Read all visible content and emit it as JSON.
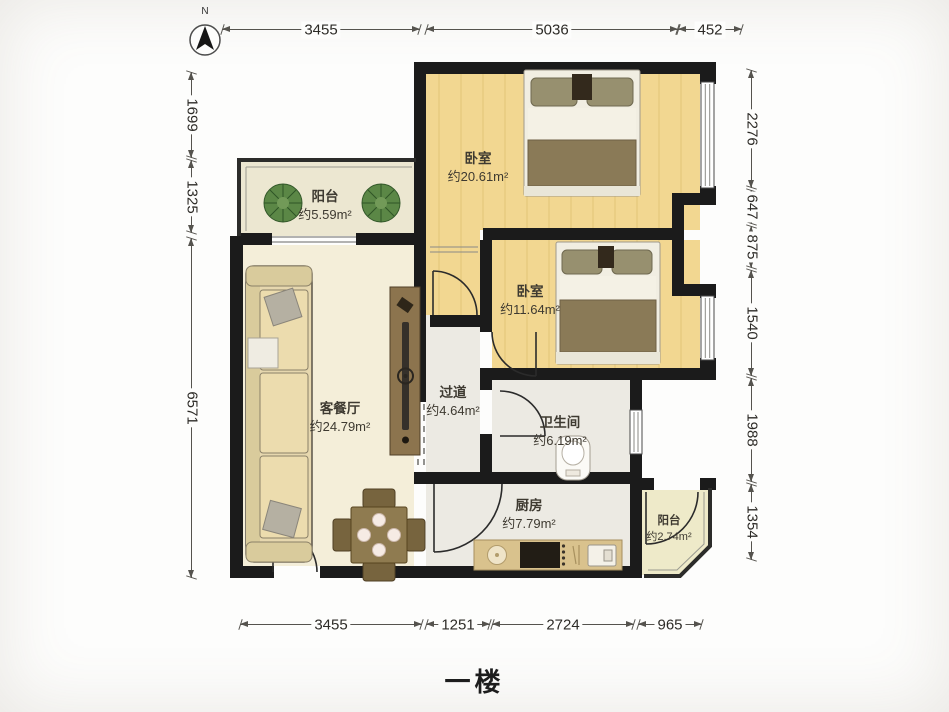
{
  "title": "一楼",
  "compass": {
    "label": "N"
  },
  "rooms": [
    {
      "id": "balcony-top",
      "name": "阳台",
      "area": "约5.59m²"
    },
    {
      "id": "bedroom-1",
      "name": "卧室",
      "area": "约20.61m²"
    },
    {
      "id": "bedroom-2",
      "name": "卧室",
      "area": "约11.64m²"
    },
    {
      "id": "living-dining",
      "name": "客餐厅",
      "area": "约24.79m²"
    },
    {
      "id": "hallway",
      "name": "过道",
      "area": "约4.64m²"
    },
    {
      "id": "bathroom",
      "name": "卫生间",
      "area": "约6.19m²"
    },
    {
      "id": "kitchen",
      "name": "厨房",
      "area": "约7.79m²"
    },
    {
      "id": "balcony-bottom",
      "name": "阳台",
      "area": "约2.74m²"
    }
  ],
  "dimensions": {
    "top": [
      "3455",
      "5036",
      "452"
    ],
    "bottom": [
      "3455",
      "1251",
      "2724",
      "965"
    ],
    "left": [
      "1699",
      "1325",
      "6571"
    ],
    "right": [
      "2276",
      "647",
      "875",
      "1540",
      "1988",
      "1354"
    ]
  },
  "colors": {
    "wall": "#1b1b1b",
    "bedroomFloor": "#f2d791",
    "plank": "#ddbd6d",
    "livingFloor": "#f4eed9",
    "balconyFloor": "#ece7d1",
    "balcony2Floor": "#eeeac9",
    "wetFloor": "#eceae3",
    "counter": "#d9c28d",
    "woodFurniture": "#8f7b50",
    "blanket": "#8a7a57",
    "sofaCushion": "#ecdcae",
    "plantGreen": "#5b8746"
  }
}
